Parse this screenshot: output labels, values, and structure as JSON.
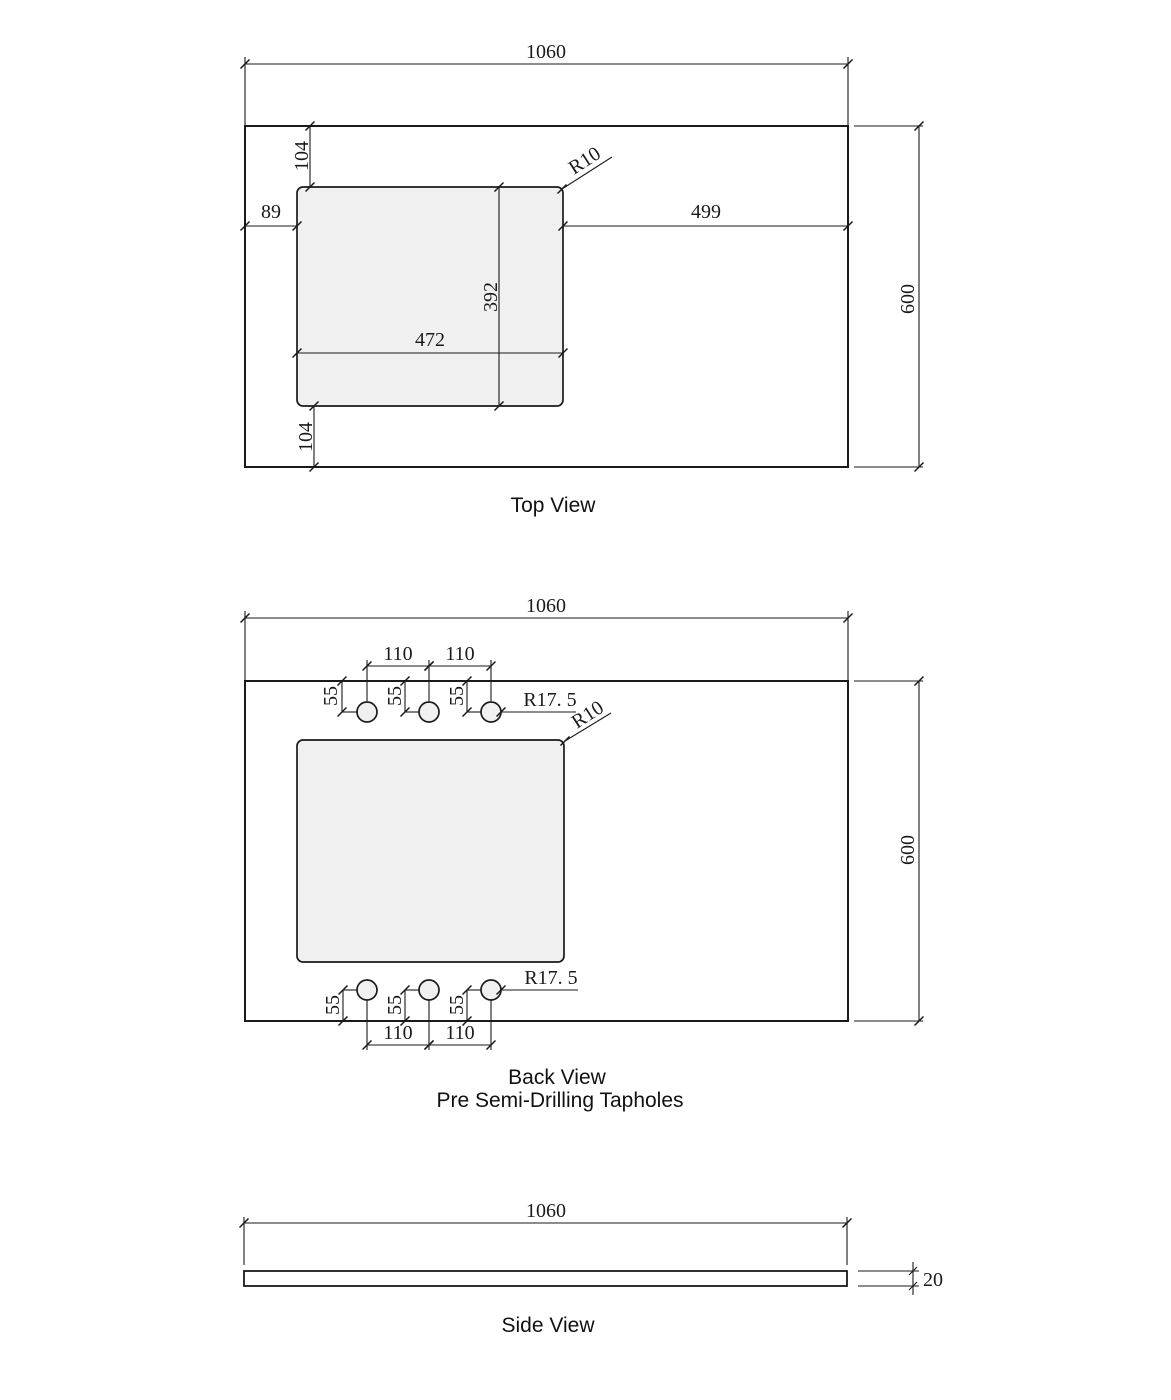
{
  "drawing": {
    "background": "#ffffff",
    "line_color": "#1a1a1a",
    "cutout_fill": "#f0f0f0"
  },
  "top_view": {
    "title": "Top View",
    "dim_overall_width": "1060",
    "dim_overall_depth": "600",
    "dim_cutout_offset_top": "104",
    "dim_cutout_offset_bottom": "104",
    "dim_cutout_offset_left": "89",
    "dim_cutout_to_right_edge": "499",
    "dim_cutout_width": "472",
    "dim_cutout_depth": "392",
    "label_corner_radius": "R10"
  },
  "back_view": {
    "title": "Back View",
    "subtitle": "Pre Semi-Drilling Tapholes",
    "dim_overall_width": "1060",
    "dim_overall_depth": "600",
    "dim_taphole_spacing": "110",
    "dim_taphole_edge_offset": "55",
    "label_taphole_radius": "R17. 5",
    "label_corner_radius": "R10"
  },
  "side_view": {
    "title": "Side View",
    "dim_overall_width": "1060",
    "dim_thickness": "20"
  }
}
